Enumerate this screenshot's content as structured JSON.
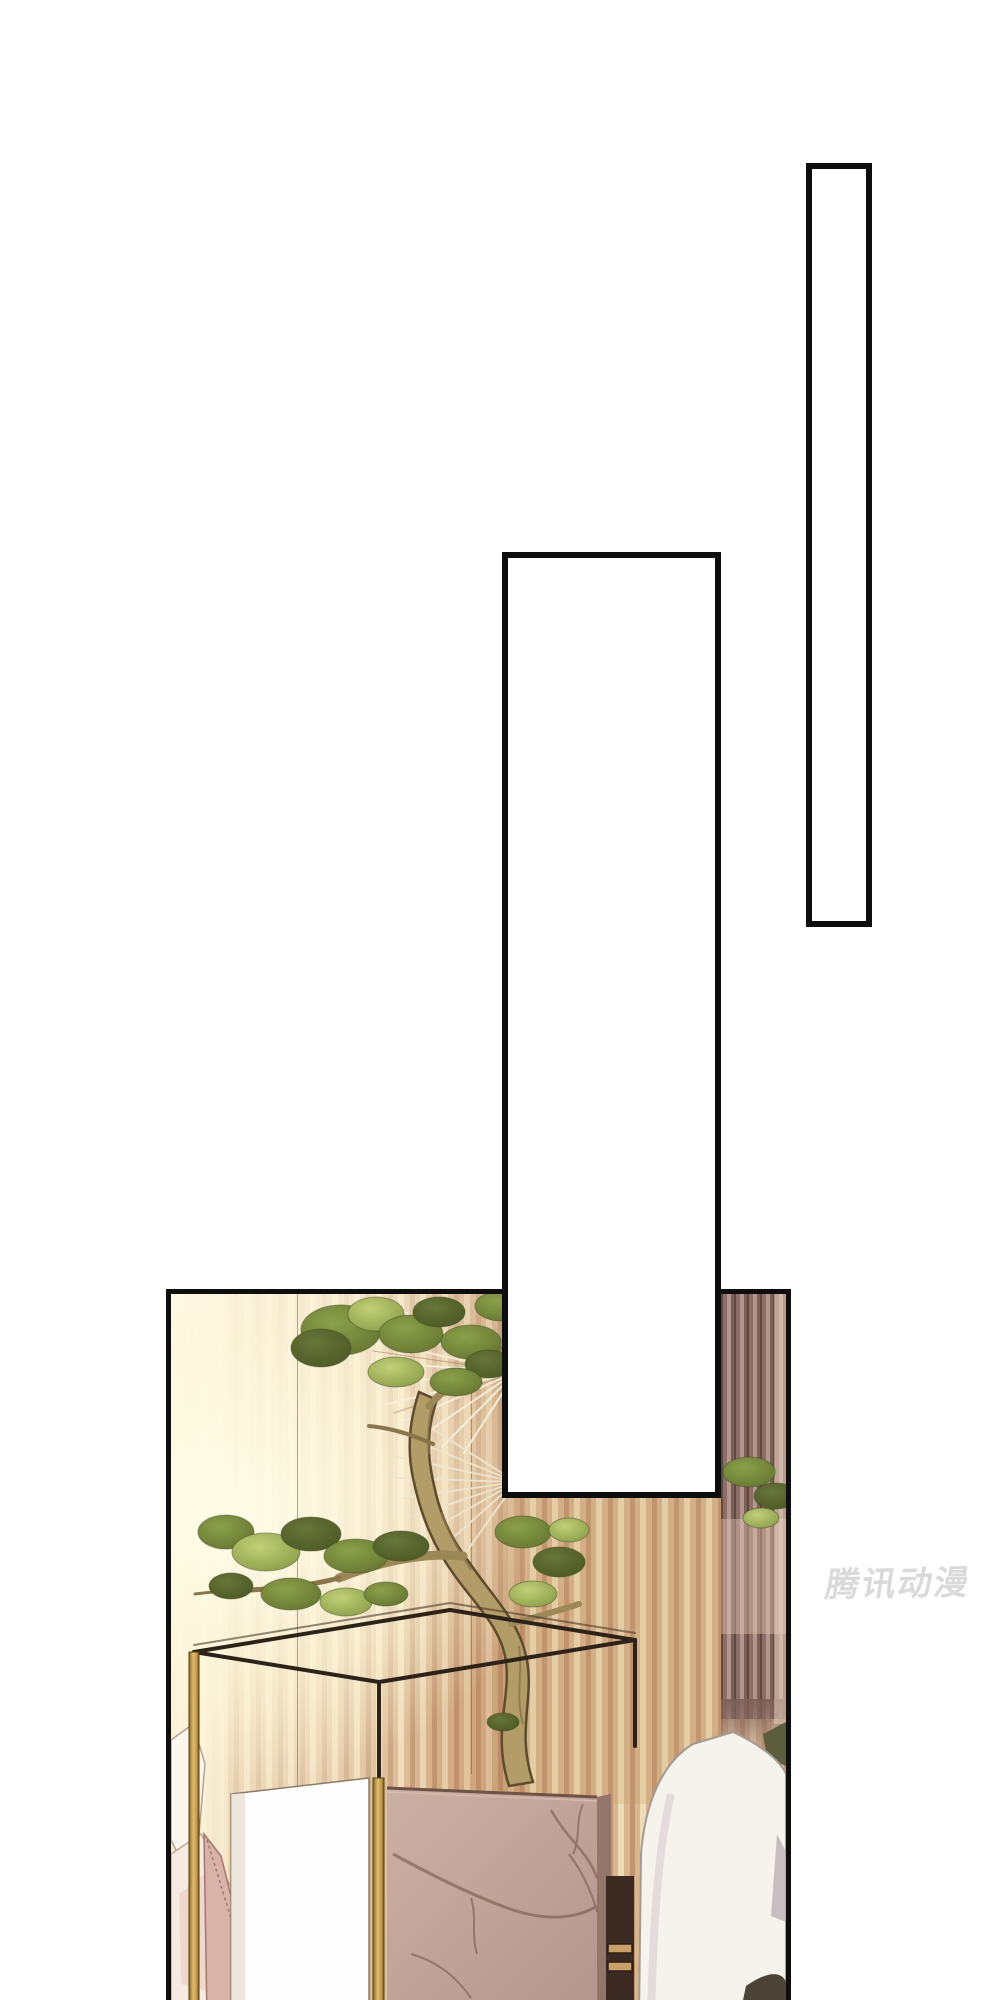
{
  "page": {
    "kind": "comic-page",
    "background": "#ffffff",
    "width_px": 1000,
    "height_px": 2000
  },
  "speech_boxes": {
    "narrow": {
      "text": "",
      "fill": "#ffffff",
      "border_color": "#0d0d0d"
    },
    "wide": {
      "text": "",
      "fill": "#ffffff",
      "border_color": "#0d0d0d"
    }
  },
  "watermark": {
    "text": "腾讯动漫",
    "color": "#dadada"
  },
  "illustration": {
    "alt": "Bonsai tree with curving trunk inside a thin gold-and-dark wireframe display case on a pink marble pedestal, slatted wood wall lit by sunlight, white pillows at both sides",
    "panel_border_color": "#0e0e0e",
    "palette": {
      "wall_light": "#eedbb8",
      "wall_warm": "#c09672",
      "wall_dark_mauve": "#7c5f57",
      "sunlight": "#fffdE8",
      "foliage_dark": "#4e5c2a",
      "foliage_mid": "#72863a",
      "foliage_light": "#9db153",
      "trunk": "#b29c67",
      "marble": "#c3a79c",
      "marble_vein": "#7d5f53",
      "frame_gold": "#c49a4e",
      "frame_dark": "#2c2218",
      "pillow_white": "#f7f4ec",
      "pillow_pink": "#d9b2a9",
      "cushion_olive": "#5d5c3c"
    }
  }
}
